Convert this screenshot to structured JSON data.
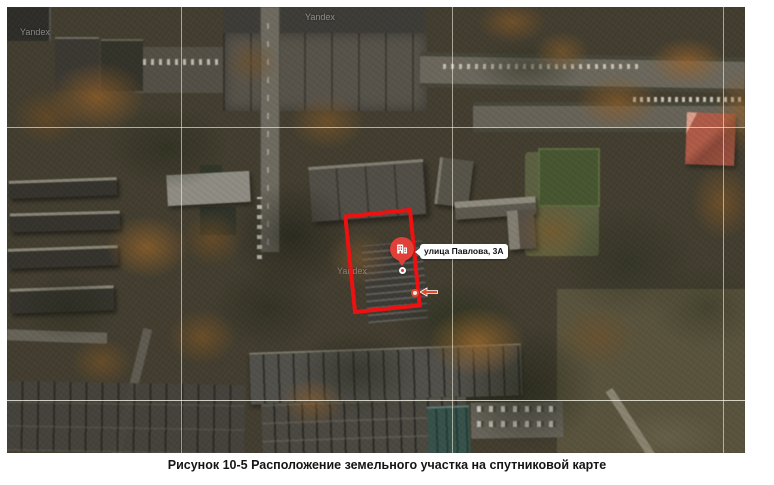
{
  "figure": {
    "caption": "Рисунок 10-5 Расположение земельного участка на  спутниковой карте"
  },
  "map": {
    "kind": "satellite map",
    "watermark_text": "Yandex",
    "address_label": "улица Павлова, 3А",
    "icons": {
      "marker": "building-icon",
      "pointer": "arrow-left-icon"
    },
    "colors": {
      "plot_outline": "#ee1111",
      "marker": "#e04038",
      "pointer_arrow": "#dd4a2c",
      "grid_line": "#fffbe8"
    }
  }
}
